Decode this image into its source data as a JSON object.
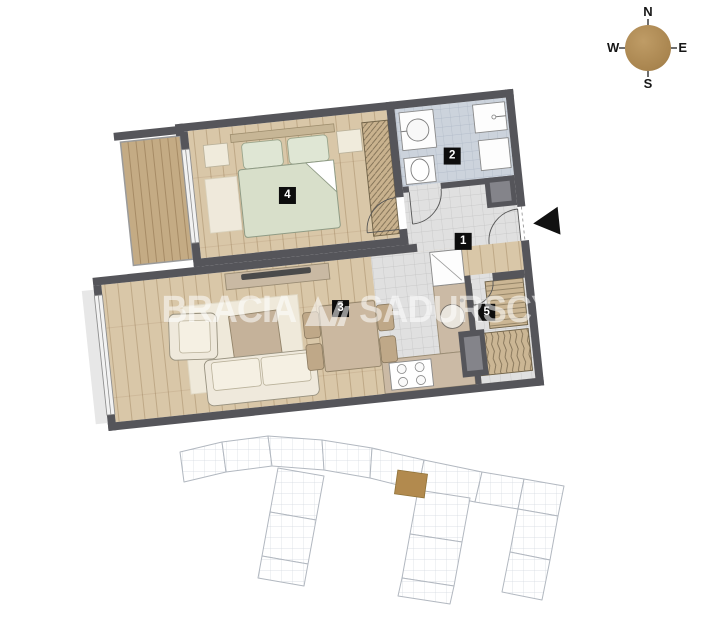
{
  "compass": {
    "north": "N",
    "east": "E",
    "south": "S",
    "west": "W"
  },
  "watermark": {
    "brand_left": "BRACIA",
    "brand_right": "SADURSCY"
  },
  "floor_plan": {
    "rooms": [
      {
        "number": "1",
        "name": "hall"
      },
      {
        "number": "2",
        "name": "bathroom"
      },
      {
        "number": "3",
        "name": "living-room-with-kitchenette"
      },
      {
        "number": "4",
        "name": "bedroom"
      },
      {
        "number": "5",
        "name": "wardrobe"
      }
    ],
    "entrance": {
      "marker": "left-pointing-triangle"
    }
  },
  "colors": {
    "wall": "#55555a",
    "wood_floor": "#d9c7a8",
    "balcony_floor": "#c4ab84",
    "bathroom_tile": "#ccd3dc",
    "gray_tile": "#e0e0e0",
    "bed": "#d8dfca",
    "upholstery": "#efe9dc",
    "counter": "#cbbaa5",
    "site_highlight": "#b28a4e",
    "compass_dial": "#a9854f"
  }
}
